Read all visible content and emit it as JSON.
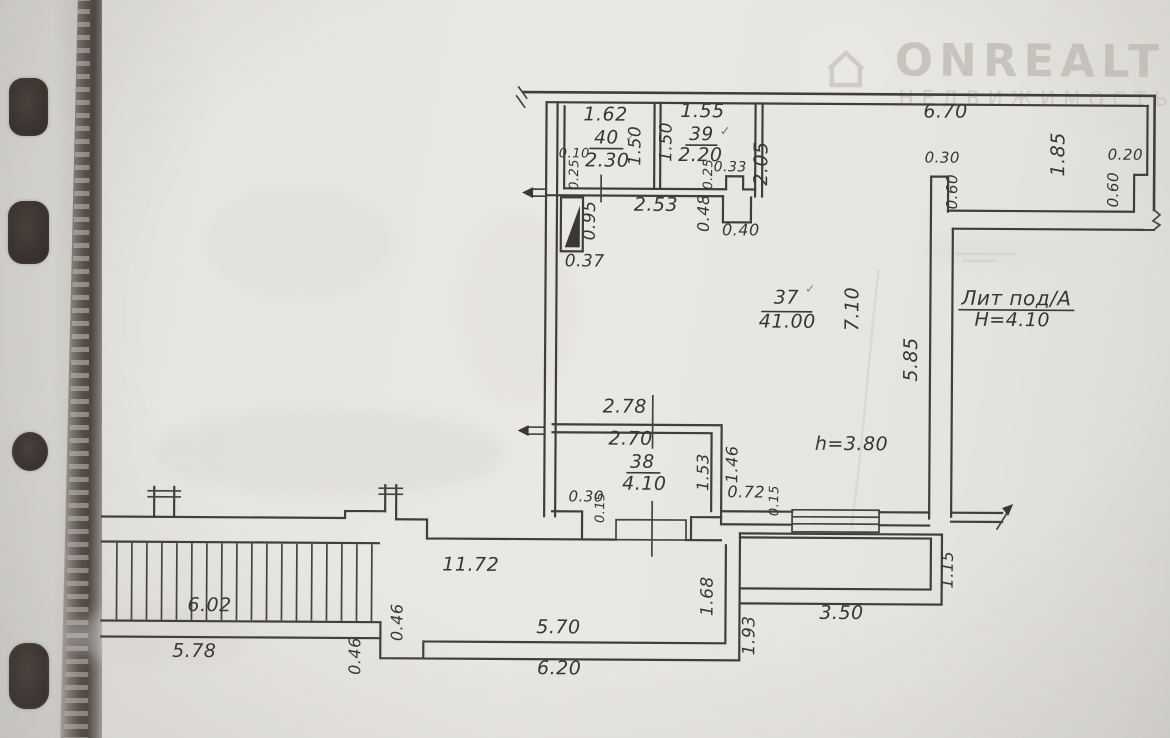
{
  "watermark": {
    "brand": "ONREALT",
    "subtitle": "НЕДВИЖИМОСТЬ"
  },
  "building": {
    "label": "Лит под/А",
    "height": "Н=4.10"
  },
  "rooms": {
    "r37": {
      "number": "37",
      "area": "41.00"
    },
    "r38": {
      "number": "38",
      "area": "4.10"
    },
    "r39": {
      "number": "39",
      "area": "2.20"
    },
    "r40": {
      "number": "40",
      "area": "2.30"
    }
  },
  "dims": {
    "r40_width": "1.62",
    "r39_width": "1.55",
    "r40_depth": "1.50",
    "r39_depth": "1.50",
    "r40_offset": "0.10",
    "r40_wall": "0.25",
    "r39_wall": "0.25",
    "r39_notch": "0.33",
    "wing_left_height": "2.05",
    "hall_width": "2.53",
    "shaft_height": "0.48",
    "shaft_width": "0.40",
    "duct_height": "0.95",
    "duct_width": "0.37",
    "wing_length": "6.70",
    "pillar_width": "0.30",
    "pillar_height": "0.60",
    "wing_width": "1.85",
    "notch_width": "0.20",
    "notch_height": "0.60",
    "r37_length": "7.10",
    "r37_right_wall": "5.85",
    "r37_ceiling": "h=3.80",
    "r38_width_outer": "2.78",
    "r38_width_inner": "2.70",
    "r38_height_inner": "1.53",
    "r38_height_outer": "1.46",
    "nook_width": "0.72",
    "nook_wall": "0.15",
    "r38_offset": "0.30",
    "r38_wall": "0.15",
    "walkway_length": "11.72",
    "stairs_length": "6.02",
    "stairs_outer": "5.78",
    "step_a": "0.46",
    "step_b": "0.46",
    "porch_left_inner": "5.70",
    "porch_left_outer": "6.20",
    "right_wall_inner": "1.68",
    "right_wall_outer": "1.93",
    "porch_right_width": "3.50",
    "porch_right_height": "1.15"
  },
  "marks": {
    "check": "✓"
  },
  "colors": {
    "ink": "#403e3b",
    "paper": "#e9e7e3",
    "watermark": "#c7c4be",
    "binding": "#564f49"
  }
}
